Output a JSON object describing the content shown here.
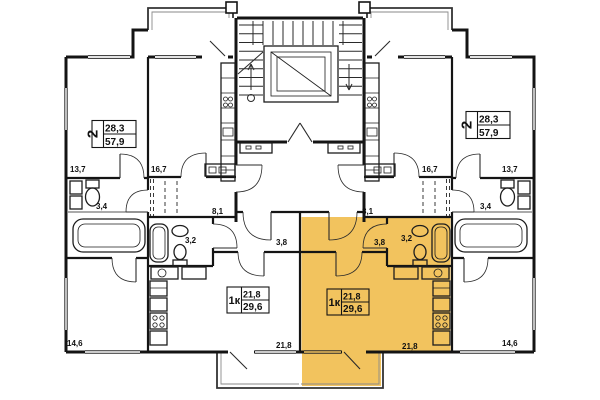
{
  "colors": {
    "highlight": "#F2C35E",
    "wall": "#141414",
    "background": "#ffffff"
  },
  "apartments": {
    "two_room_left": {
      "type": "2",
      "living_area": "28,3",
      "total_area": "57,9"
    },
    "two_room_right": {
      "type": "2",
      "living_area": "28,3",
      "total_area": "57,9"
    },
    "one_room_left": {
      "type": "1к",
      "living_area": "21,8",
      "total_area": "29,6"
    },
    "one_room_right": {
      "type": "1к",
      "living_area": "21,8",
      "total_area": "29,6",
      "highlighted": true
    }
  },
  "rooms": {
    "two_left": {
      "bedroom_top": "13,7",
      "kitchen": "16,7",
      "bathroom": "3,4",
      "hall": "8,1",
      "bedroom_bottom": "14,6"
    },
    "two_right": {
      "bedroom_top": "13,7",
      "kitchen": "16,7",
      "bathroom": "3,4",
      "hall": "8,1",
      "bedroom_bottom": "14,6"
    },
    "one_left": {
      "bathroom": "3,2",
      "hall": "3,8",
      "living": "21,8"
    },
    "one_right": {
      "bathroom": "3,2",
      "hall": "3,8",
      "living": "21,8"
    }
  }
}
